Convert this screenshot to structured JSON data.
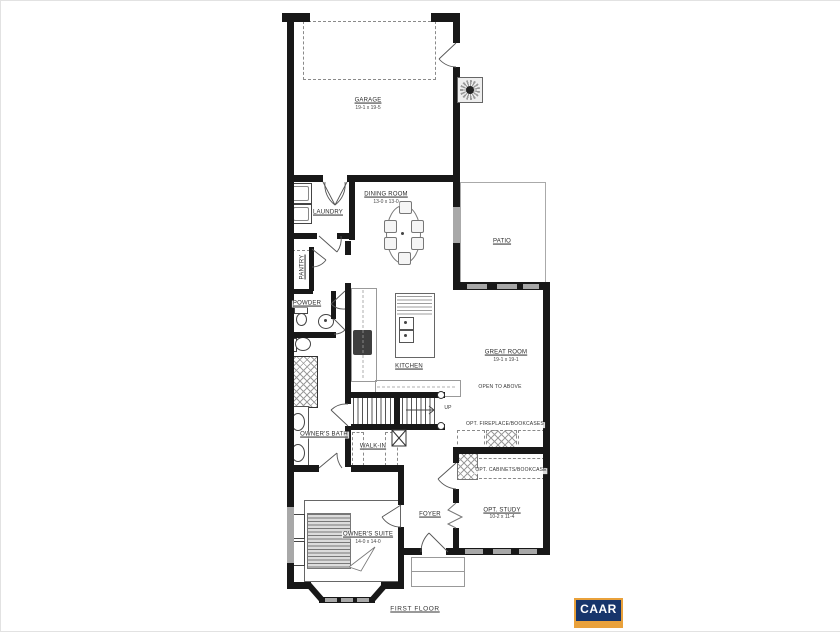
{
  "plan": {
    "footer_label": "FIRST FLOOR",
    "colors": {
      "wall": "#181818",
      "window_glass": "#a8a8a8",
      "logo_navy": "#17356b",
      "logo_orange": "#e9a13b"
    },
    "rooms": {
      "garage": {
        "name": "GARAGE",
        "dims": "19-1 x 19-5"
      },
      "laundry": {
        "name": "LAUNDRY"
      },
      "dining": {
        "name": "DINING ROOM",
        "dims": "13-0 x 13-0"
      },
      "patio": {
        "name": "PATIO"
      },
      "pantry": {
        "name": "PANTRY"
      },
      "powder": {
        "name": "POWDER"
      },
      "kitchen": {
        "name": "KITCHEN"
      },
      "great_room": {
        "name": "GREAT ROOM",
        "dims": "19-1 x 19-1",
        "note_open": "OPEN TO ABOVE",
        "note_fireplace": "OPT. FIREPLACE/BOOKCASES"
      },
      "owners_bath": {
        "name": "OWNER'S BATH"
      },
      "walk_in": {
        "name": "WALK-IN"
      },
      "owners_suite": {
        "name": "OWNER'S SUITE",
        "dims": "14-0 x 14-0"
      },
      "foyer": {
        "name": "FOYER"
      },
      "study": {
        "name": "OPT. STUDY",
        "dims": "10-2 x 11-4",
        "note_cabinets": "OPT. CABINETS/BOOKCASE"
      }
    },
    "stairs": {
      "label": "UP"
    },
    "logo": {
      "text": "CAAR"
    }
  }
}
